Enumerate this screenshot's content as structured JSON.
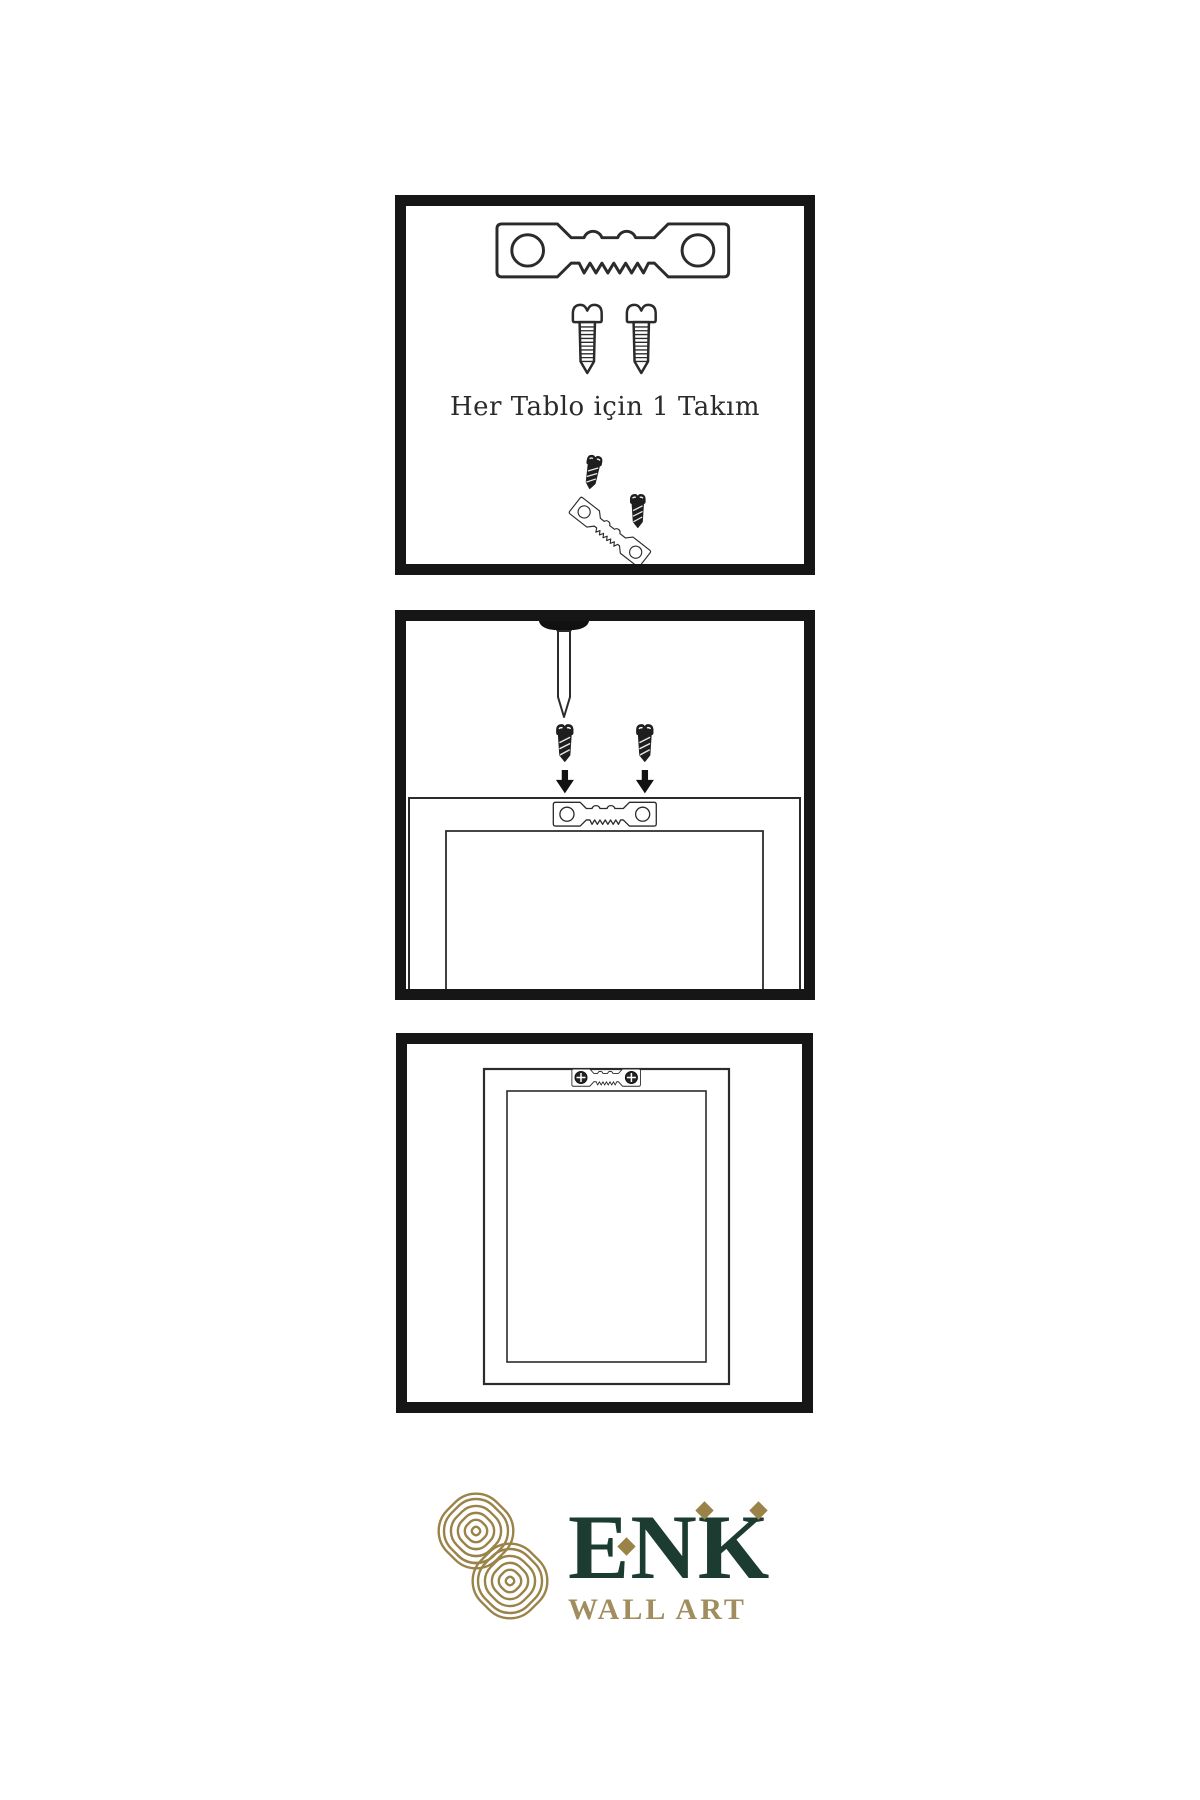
{
  "page": {
    "background": "#ffffff"
  },
  "colors": {
    "outline_ink": "#2b2b2b",
    "panel_border": "#161616",
    "hardware_dark": "#1e1e1e",
    "brand_green": "#1d3c31",
    "brand_gold": "#9a8348",
    "brand_tan": "#a18d5e"
  },
  "panels": [
    {
      "name": "hardware-kit",
      "caption": "Her Tablo için 1 Takım",
      "icons": [
        "sawtooth-hanger-icon",
        "screw-icon",
        "screw-icon",
        "dark-screw-icon",
        "tilted-sawtooth-hanger-icon",
        "dark-screw-icon"
      ]
    },
    {
      "name": "mounting-steps",
      "icons": [
        "wall-nail-icon",
        "dark-screw-icon",
        "dark-screw-icon",
        "arrow-down-icon",
        "arrow-down-icon",
        "sawtooth-hanger-icon",
        "frame-back-icon"
      ]
    },
    {
      "name": "hung-frame",
      "icons": [
        "frame-front-icon",
        "mounted-hanger-icon",
        "phillips-screw-icon",
        "phillips-screw-icon"
      ]
    }
  ],
  "logo": {
    "icon": "knot-logo-icon",
    "brand": "ENK",
    "subtitle": "WALL ART"
  }
}
